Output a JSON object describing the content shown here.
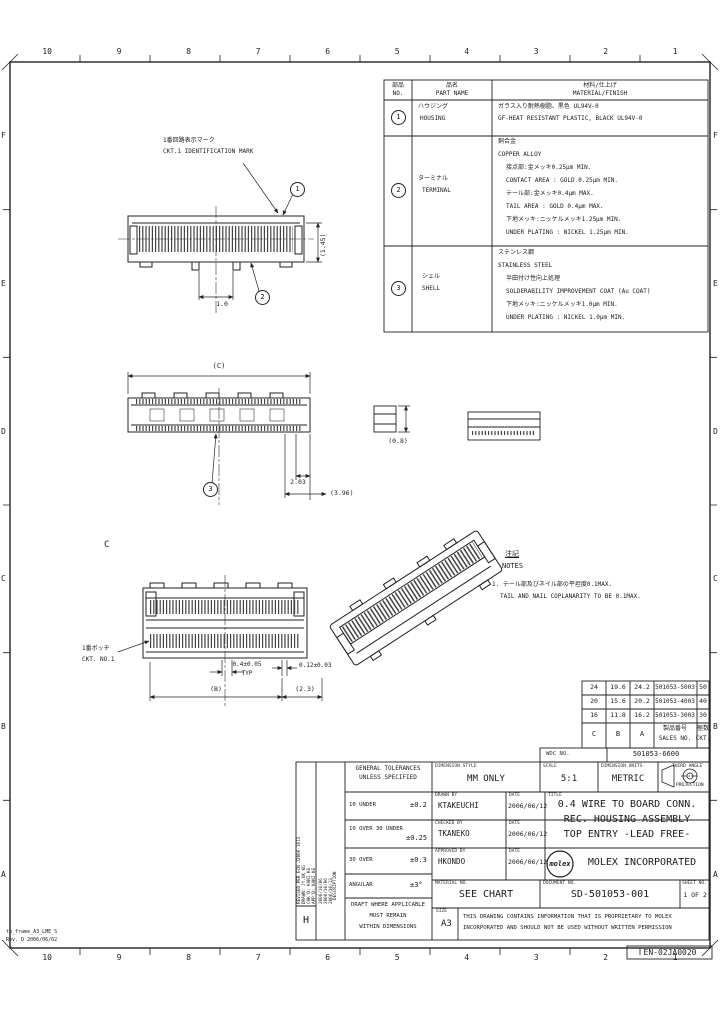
{
  "drawing": {
    "zones": {
      "columns": [
        "10",
        "9",
        "8",
        "7",
        "6",
        "5",
        "4",
        "3",
        "2",
        "1"
      ],
      "rows": [
        "F",
        "E",
        "D",
        "C",
        "B",
        "A"
      ]
    },
    "material_table": {
      "headers": {
        "no_jp": "部品",
        "no_en": "NO.",
        "part_jp": "品名",
        "part_en": "PART NAME",
        "mat_jp": "材料/仕上げ",
        "mat_en": "MATERIAL/FINISH"
      },
      "rows": [
        {
          "balloon": "1",
          "part_jp": "ハウジング",
          "part_en": "HOUSING",
          "lines": [
            "ガラス入り耐熱樹脂、黒色 UL94V-0",
            "GF-HEAT RESISTANT PLASTIC, BLACK UL94V-0"
          ]
        },
        {
          "balloon": "2",
          "part_jp": "ターミナル",
          "part_en": "TERMINAL",
          "lines": [
            "銅合金",
            "COPPER ALLOY",
            "接点部:金メッキ0.25μm MIN.",
            "CONTACT AREA : GOLD 0.25μm MIN.",
            "テール部:金メッキ0.4μm MAX.",
            "TAIL AREA : GOLD 0.4μm MAX.",
            "下地メッキ:ニッケルメッキ1.25μm MIN.",
            "UNDER PLATING : NICKEL 1.25μm MIN."
          ]
        },
        {
          "balloon": "3",
          "part_jp": "シェル",
          "part_en": "SHELL",
          "lines": [
            "ステンレス鋼",
            "STAINLESS STEEL",
            "半田付け性向上処理",
            "SOLDERABILITY IMPROVEMENT COAT (Au COAT)",
            "下地メッキ:ニッケルメッキ1.0μm MIN.",
            "UNDER PLATING : NICKEL 1.0μm MIN."
          ]
        }
      ]
    },
    "notes": {
      "title_jp": "注記",
      "title_en": "NOTES",
      "item1_jp": "1. テール部及びネイル部の平坦度0.1MAX.",
      "item1_en": "TAIL AND NAIL COPLANARITY TO BE 0.1MAX."
    },
    "callouts": {
      "id_mark_jp": "1番回路表示マーク",
      "id_mark_en": "CKT.1 IDENTIFICATION MARK",
      "botch_jp": "1番ボッチ",
      "botch_en": "CKT. NO.1"
    },
    "balloons": {
      "b1": "1",
      "b2": "2",
      "b3": "3"
    },
    "dims": {
      "v1_a": "1.0",
      "v1_b": "(1.45)",
      "v2_w": "(C)",
      "v2_a": "2.03",
      "v2_b": "(3.96)",
      "v2_c": "(0.8)",
      "v3_p1": "0.4±0.05",
      "v3_p1b": "TYP",
      "v3_p2": "0.12±0.03",
      "v3_w": "(B)",
      "v3_e": "(2.3)",
      "section": "C"
    },
    "chart_table": {
      "header": {
        "c": "C",
        "b": "B",
        "a": "A",
        "sales_jp": "製品番号",
        "sales_en": "SALES NO.",
        "ckt_jp": "極数",
        "ckt_en": "CKT."
      },
      "rows": [
        {
          "c": "24",
          "b": "19.6",
          "a": "24.2",
          "sales": "501053-5003",
          "ckt": "50"
        },
        {
          "c": "20",
          "b": "15.6",
          "a": "20.2",
          "sales": "501053-4003",
          "ckt": "40"
        },
        {
          "c": "16",
          "b": "11.8",
          "a": "16.2",
          "sales": "501053-3003",
          "ckt": "30"
        }
      ]
    },
    "title_block": {
      "wdc_label": "WDC NO.",
      "wdc_value": "501053-6600",
      "dim_style_label": "DIMENSION STYLE",
      "dim_style_value": "MM ONLY",
      "scale_label": "SCALE",
      "scale_value": "5:1",
      "units_label": "DIMENSION UNITS",
      "units_value": "METRIC",
      "projection_line1": "THIRD ANGLE",
      "projection_line2": "PROJECTION",
      "drawn_label": "DRAWN BY",
      "drawn_value": "KTAKEUCHI",
      "date_label": "DATE",
      "drawn_date": "2006/06/12",
      "checked_label": "CHECKED BY",
      "checked_value": "TKANEKO",
      "checked_date": "2006/06/12",
      "approved_label": "APPROVED BY",
      "approved_value": "HKONDO",
      "approved_date": "2006/06/12",
      "title_label": "TITLE",
      "title_line1": "0.4 WIRE TO BOARD CONN.",
      "title_line2": "REC. HOUSING ASSEMBLY",
      "title_line3": "TOP ENTRY  -LEAD FREE-",
      "logo_text": "molex",
      "company": "MOLEX INCORPORATED",
      "material_label": "MATERIAL NO.",
      "material_value": "SEE CHART",
      "document_label": "DOCUMENT NO.",
      "document_value": "SD-501053-001",
      "sheet_label": "SHEET NO.",
      "sheet_value": "1 OF 2",
      "size_label": "SIZE",
      "size_value": "A3",
      "prop_line1": "THIS DRAWING CONTAINS INFORMATION THAT IS PROPRIETARY TO MOLEX",
      "prop_line2": "INCORPORATED AND SHOULD NOT BE USED WITHOUT WRITTEN PERMISSION",
      "tolerances": {
        "header_line1": "GENERAL TOLERANCES",
        "header_line2": "UNLESS SPECIFIED",
        "rows": [
          {
            "range": "10 UNDER",
            "value": "±0.2"
          },
          {
            "range": "10 OVER 30 UNDER",
            "value": "±0.25"
          },
          {
            "range": "30 OVER",
            "value": "±0.3"
          },
          {
            "range": "ANGULAR",
            "value": "±3°"
          }
        ],
        "draft_line1": "DRAFT WHERE APPLICABLE",
        "draft_line2": "MUST REMAIN",
        "draft_line3": "WITHIN DIMENSIONS"
      },
      "revision": {
        "letter": "H",
        "desc_label": "DESCRIPTION",
        "lines": [
          "REVISED PER ECN J2006-1013",
          "DRAWN: JY.UK KG",
          "CHK'D: KANI KG",
          "APP'D: KANI KG"
        ],
        "dates": [
          "2006/10/06",
          "2006/10/06",
          "2006/10/13"
        ]
      }
    },
    "footer": {
      "frame_id": "tb_frame_A3_LME_S",
      "frame_rev": "Rev. D 2006/06/02",
      "code": "EN-02JA0020"
    }
  }
}
